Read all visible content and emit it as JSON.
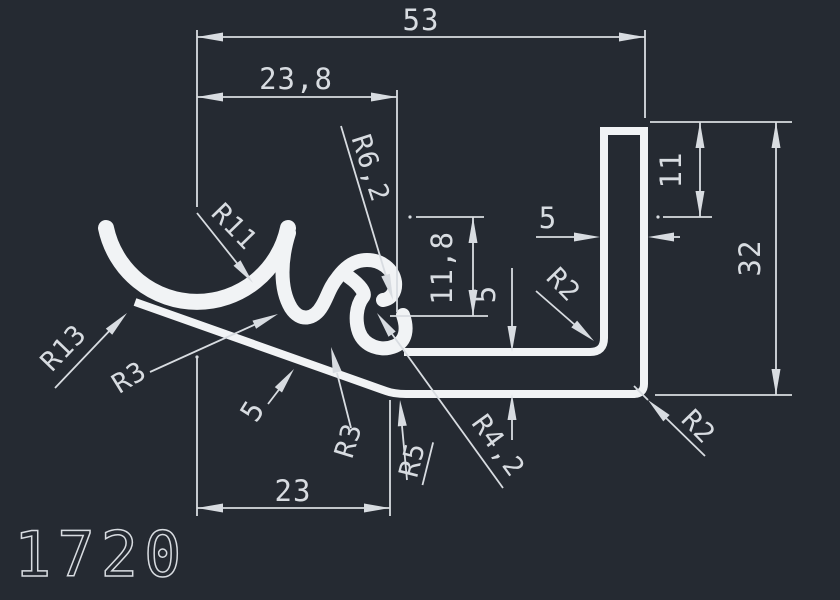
{
  "drawing": {
    "part_number": "1720",
    "colors": {
      "background": "#252A32",
      "profile_line": "#F1F3F5",
      "dimension_line": "#D8DCE1"
    },
    "dimensions": {
      "total_width": "53",
      "hook_offset": "23,8",
      "web_width": "23",
      "slot_depth": "11,8",
      "mid_wall": "5",
      "leg_top_offset": "11",
      "leg_height": "32",
      "leg_width": "5",
      "web_thickness": "5"
    },
    "radii": {
      "cup_inner": "R11",
      "cup_outer": "R13",
      "fillet_left": "R3",
      "fillet_dip": "R3",
      "fillet_junction": "R5",
      "curl_inner": "R4,2",
      "curl_outer": "R6,2",
      "leg_inner_fillet": "R2",
      "leg_outer_fillet": "R2"
    }
  }
}
